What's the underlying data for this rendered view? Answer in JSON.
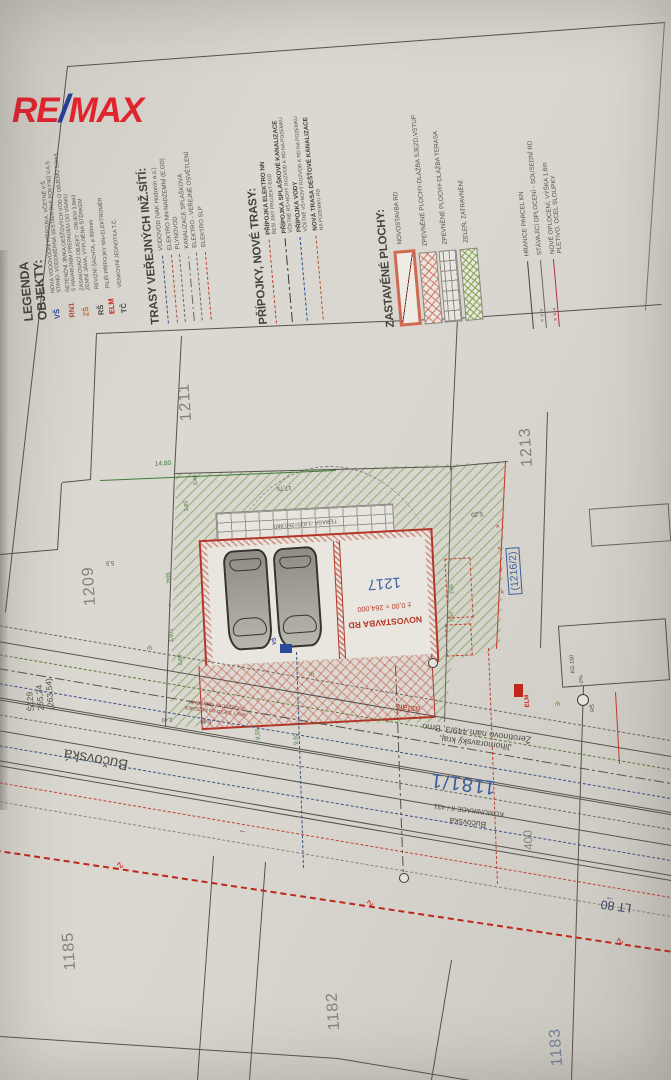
{
  "logo": {
    "re": "RE",
    "slash": "/",
    "max": "MAX"
  },
  "legend": {
    "objekty": {
      "title": "LEGENDA",
      "subtitle": "OBJEKTY:",
      "items": [
        {
          "code": "VŠ",
          "desc": "NOVÁ VODOVODNÍ PŘÍPOJKA, VČETNĚ V.Š.\nSTAND. VODOMĚRNÁ SESTAVA DLE POKYNŮ V.A.S"
        },
        {
          "code": "RN1",
          "desc": "RETENČNÍ JÍMKA DEŠŤOVÝCH VOD O OBJEMU 5,0m3\nS HAVARIJNÍM PŘEPADEM DO VSAKU"
        },
        {
          "code": "ZŠ",
          "desc": "ZASAKOVACÍ OBJEKT - OBJEM 3,9m3\nZEMNÍ JÁMA, VYPLNĚNÁ ŠTĚRKEM"
        },
        {
          "code": "RŠ",
          "desc": "REVIZNÍ ŠACHTA, ⌀ 300mm"
        },
        {
          "code": "ELM",
          "desc": "PILÍŘ PŘÍPOJKY NN+ELEKTROMĚR"
        },
        {
          "code": "TČ",
          "desc": "VENKOVNÍ JEDNOTKA T.Č."
        }
      ]
    },
    "trasy": {
      "title": "TRASY VEŘEJNÝCH INŽ.SÍTÍ:",
      "items": [
        {
          "label": "VODOVOD (VAK Hodonín a.s.)"
        },
        {
          "label": "ELEKTRO NN-NADZEMNÍ (E.GD)"
        },
        {
          "label": "PLYNOVOD"
        },
        {
          "label": "KANALIZACE SPLAŠKOVÁ"
        },
        {
          "label": "ELEKTRO - VEŘEJNÉ OSVĚTLENÍ"
        },
        {
          "label": "ELEKTRO SLP"
        }
      ]
    },
    "pripojky": {
      "title": "PŘÍPOJKY, NOVÉ TRASY:",
      "items": [
        {
          "label": "PŘÍPOJKA ELEKTRO NN",
          "sub": "ŘEŠÍ JINÝ PROJEKT-EGD"
        },
        {
          "label": "PŘÍPOJKA SPLAŠKOVÉ KANALIZACE",
          "sub": "VČETNĚ RŠ+NOVÝ ROZVOD K RD NA POZEMKU"
        },
        {
          "label": "PŘÍPOJKA VODY",
          "sub": "VČETNĚ VŠ+NOVÝ ROZVOD K RD NA POZEMKU"
        },
        {
          "label": "NOVÁ TRASA DEŠŤOVÉ KANALIZACE",
          "sub": "NA POZEMKU RD"
        }
      ]
    },
    "plochy": {
      "title": "ZASTAVĚNÉ PLOCHY:",
      "items": [
        {
          "label": "NOVOSTAVBA RD"
        },
        {
          "label": "ZPEVNĚNÉ PLOCHY-DLAŽBA SJEZD,VSTUP"
        },
        {
          "label": "ZPEVNĚNÉ PLOCHY-DLAŽBA TERASA"
        },
        {
          "label": "ZELEŇ, ZATRAVNĚNÍ"
        }
      ]
    },
    "hranice": {
      "items": [
        {
          "label": "HRANICE PARCEL KN"
        },
        {
          "label": "STÁVAJÍCÍ OPLOCENÍ - SOUSEDNÍ RD"
        },
        {
          "label": "NOVÉ OPLOCENÍ, VÝŠKA 1,6m\nPLETIVO, OCEL SLOUPKY"
        }
      ]
    }
  },
  "plan": {
    "parcels": {
      "p1211": "1211",
      "p1213": "1213",
      "p1209": "1209",
      "p1185": "1185",
      "p1182": "1182",
      "p1183": "1183",
      "p1216": "(1216/2)",
      "p1181": "1181/1"
    },
    "street": {
      "bucovska_big": "Bučovská",
      "bucovska_small": "Bučovská",
      "owner1": "Jihomoravský kraj,",
      "owner2": "Žerotínovo nám.449/3, Brno",
      "komunikace": "KOMUNIKACE II / 431",
      "asfalt": "asfalt",
      "lt": "LT 80",
      "s129": "Š129",
      "elev1": "265,24",
      "elev2": "(263,54)",
      "width": "400"
    },
    "building": {
      "number": "1217",
      "title": "NOVOSTAVBA RD",
      "level": "± 0,00 = 264,000",
      "terasa": "TERASA  -3,820=260,980"
    },
    "notes": {
      "sjezd1": "NOVÝ SJEZD NA POZEMEK",
      "sjezd2": "NÁJEZDOVÝ OBRUBNÍK",
      "kg": "KG 150",
      "spad": "-2%",
      "rs": "RŠ",
      "elm": "ELM",
      "vs": "VŠ"
    },
    "dims": {
      "d1": "14,80",
      "d2": "5,5",
      "d3": "7,05",
      "d4": "3,85",
      "d5": "3,40",
      "d6": "17,75",
      "d7": "5,20",
      "d8": "9,55",
      "d9": "9,50",
      "d10": "6,40",
      "d11": "2,40",
      "d12": "5,60",
      "d13": "3,00",
      "d14": "2,65",
      "d15": "1,50"
    }
  },
  "colors": {
    "remax_red": "#e0242e",
    "remax_blue": "#2a3f95",
    "plan_red": "#b23527",
    "plan_blue": "#3b5f9e",
    "plan_green": "#3f7d36",
    "line_dark": "#56534c"
  }
}
